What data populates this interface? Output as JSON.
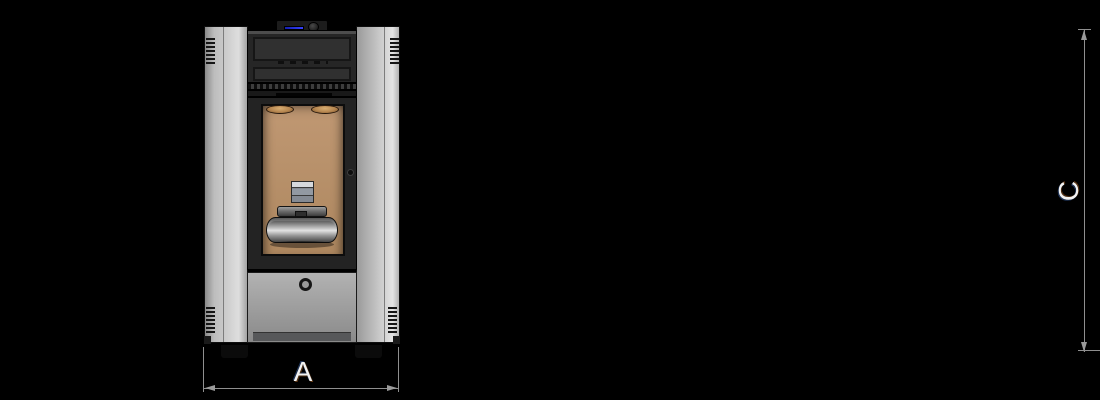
{
  "diagram": {
    "views": {
      "front": {
        "width_label": "A"
      },
      "side": {
        "depth_label": "B",
        "height_label": "C",
        "outlet_height_label": "F"
      }
    },
    "colors": {
      "background": "#000000",
      "panel_gray": "#bdbdbd",
      "hood_dark": "#262626",
      "firebox_tan": "#b7906c",
      "copper_tube": "#b5854f",
      "back_panel_blue": "#99a0b2",
      "display_blue": "#3642ff",
      "dimension_line": "#8f8f8f",
      "label_text": "#f2f2f2"
    }
  }
}
